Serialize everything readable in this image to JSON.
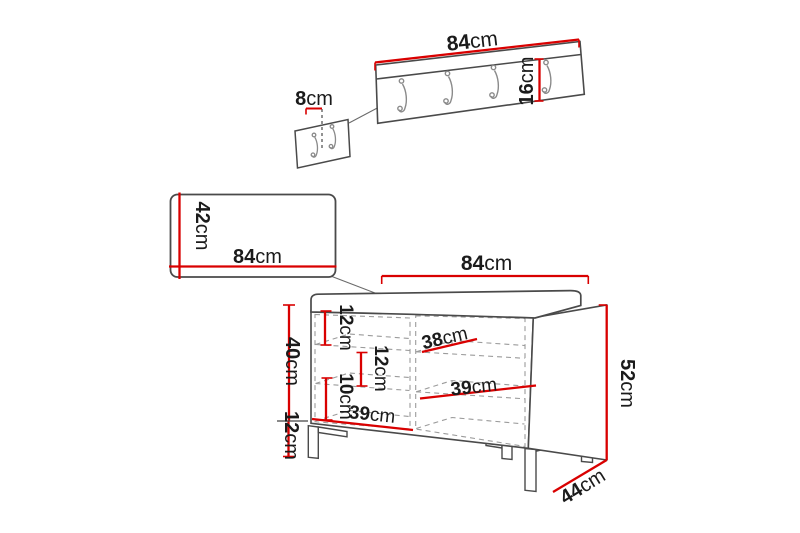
{
  "diagram": {
    "title": "hallway-furniture-set-dimensions",
    "units": "cm",
    "colors": {
      "background": "#ffffff",
      "dimension_red": "#d90000",
      "outline": "#4a4a4a",
      "dashed": "#9b9b9b",
      "hooks": "#8a8a8a",
      "leader": "#6a6a6a",
      "text": "#1b1b1b",
      "tick_dark": "#444444",
      "fill_white": "#ffffff"
    },
    "coat_rack": {
      "hooks_count": 4,
      "dims": {
        "width": {
          "value": "84",
          "unit": "cm"
        },
        "height": {
          "value": "16",
          "unit": "cm"
        },
        "hook_spacing": {
          "value": "8",
          "unit": "cm"
        }
      }
    },
    "mirror_panel": {
      "dims": {
        "width": {
          "value": "84",
          "unit": "cm"
        },
        "height": {
          "value": "42",
          "unit": "cm"
        }
      }
    },
    "bench": {
      "dims": {
        "width": {
          "value": "84",
          "unit": "cm"
        },
        "total_height": {
          "value": "52",
          "unit": "cm"
        },
        "body_height": {
          "value": "40",
          "unit": "cm"
        },
        "leg_height": {
          "value": "12",
          "unit": "cm"
        },
        "depth": {
          "value": "44",
          "unit": "cm"
        },
        "shelf1_height": {
          "value": "12",
          "unit": "cm"
        },
        "shelf2_height": {
          "value": "12",
          "unit": "cm"
        },
        "shelf3_height": {
          "value": "10",
          "unit": "cm"
        },
        "shelf_width_top": {
          "value": "38",
          "unit": "cm"
        },
        "shelf_width_middle": {
          "value": "39",
          "unit": "cm"
        },
        "shelf_width_bottom": {
          "value": "39",
          "unit": "cm"
        }
      }
    }
  }
}
